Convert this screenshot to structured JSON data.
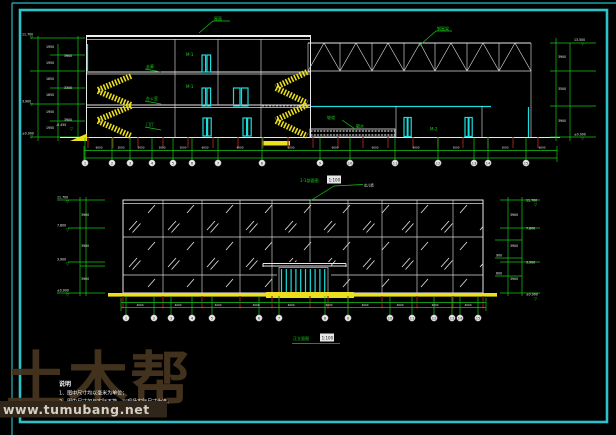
{
  "window": {
    "background": "#000000",
    "frame_color": "#2bc3c7"
  },
  "watermark": {
    "big_text": "土木帮",
    "url_text": "www.tumubang.net"
  },
  "notes": {
    "heading": "说明",
    "line1": "1、图中尺寸均以毫米为单位；",
    "line2": "2、图中尺寸如与实际不符，以现场实际尺寸为准。",
    "line3": "3、外墙装修做法详见材料做法表。"
  },
  "section": {
    "title": "1-1剖面图",
    "scale": "1:100",
    "axes": [
      "1",
      "2",
      "3",
      "4",
      "5",
      "6",
      "7",
      "8",
      "9",
      "10",
      "11",
      "12",
      "13",
      "14",
      "15"
    ],
    "axis_dims": [
      "6000",
      "3000",
      "3000",
      "3000",
      "3000",
      "6000",
      "6000",
      "6000",
      "6000",
      "6000",
      "6000",
      "3000",
      "3000",
      "6000"
    ],
    "dims_left": [
      "1950",
      "1950",
      "1650",
      "1650",
      "1950",
      "1950"
    ],
    "dims_left2": [
      "3900",
      "3300",
      "3900"
    ],
    "dims_right": [
      "3900",
      "3500",
      "3900"
    ],
    "levels": {
      "roof": "11.700",
      "floor2": "3.900",
      "ground": "±0.000",
      "truss_top": "13.500",
      "right_ground": "±0.000",
      "outdoor": "-0.450"
    },
    "labels": {
      "roof": "屋面",
      "truss": "钢屋架",
      "corridor": "走廊",
      "office": "办公室",
      "hall": "门厅",
      "door_a": "M-1",
      "door_b": "M-1",
      "door_c": "M-2",
      "ramp": "坡道",
      "apron": "散水"
    }
  },
  "elevation": {
    "title": "正立面图",
    "scale": "1:100",
    "parapet_label": "女儿墙",
    "axes": [
      "1",
      "2",
      "3",
      "4",
      "5",
      "6",
      "7",
      "8",
      "9",
      "10",
      "11",
      "12",
      "13",
      "14",
      "15"
    ],
    "axis_dims": [
      "4000",
      "4000",
      "4000",
      "4000",
      "4000",
      "4000",
      "4000",
      "4000",
      "4000",
      "4000"
    ],
    "dims_left": [
      "3900",
      "3900",
      "3900"
    ],
    "levels_left": [
      "11.700",
      "7.800",
      "3.900",
      "±0.000"
    ],
    "dims_right": [
      "3900",
      "3900",
      "3900"
    ],
    "levels_right": [
      "11.700",
      "7.800",
      "3.900",
      "±0.000"
    ],
    "dims_extra": [
      "900",
      "600"
    ]
  }
}
